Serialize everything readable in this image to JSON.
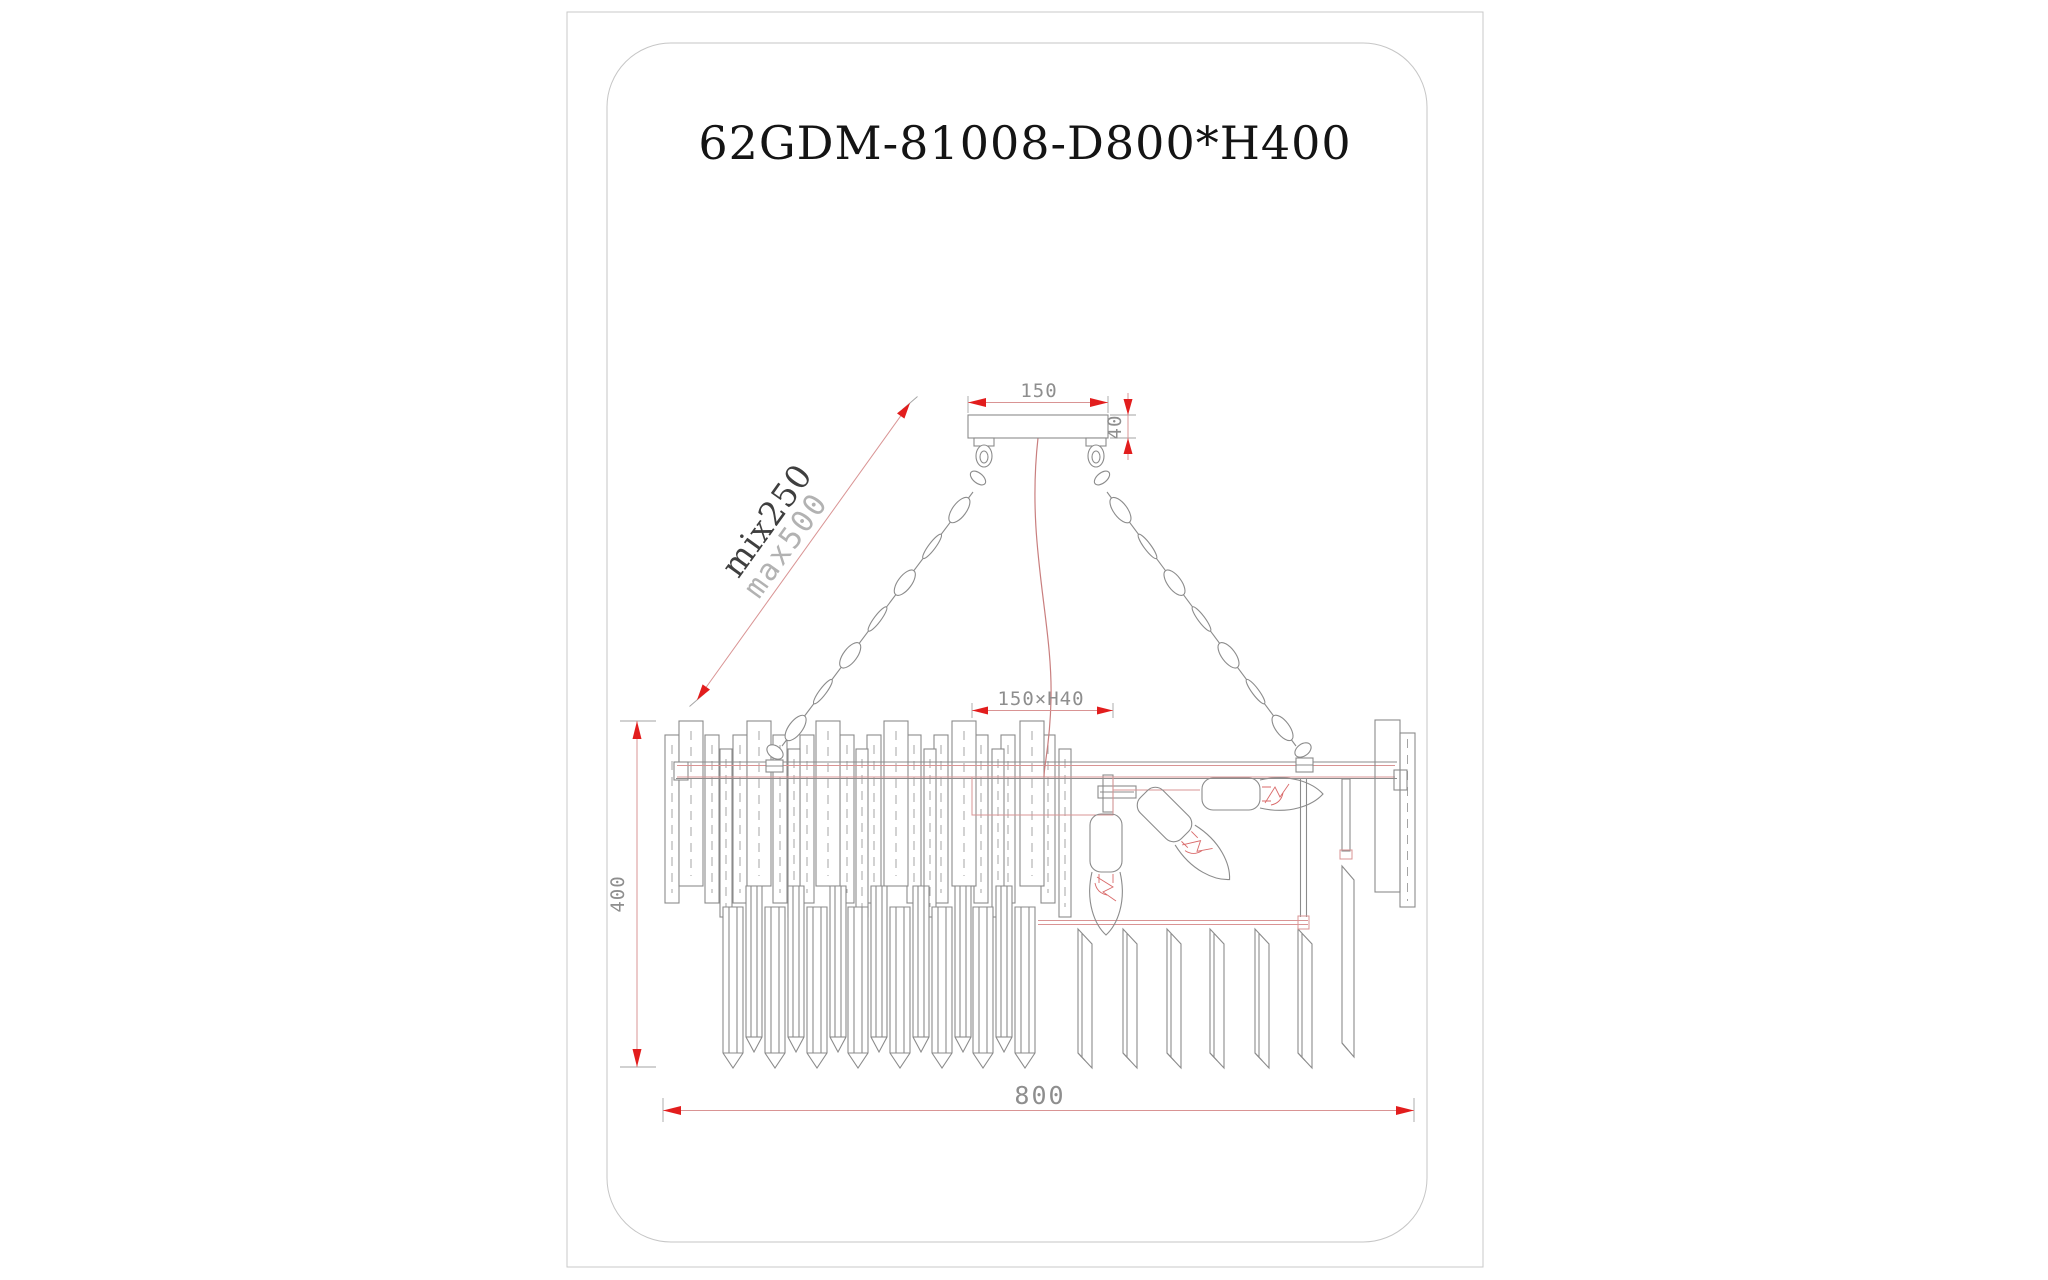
{
  "title": "62GDM-81008-D800*H400",
  "dimensions": {
    "canopy_width": "150",
    "canopy_thickness": "40",
    "chain_min": "mix250",
    "chain_max": "max500",
    "mount_plate": "150×H40",
    "fixture_height": "400",
    "fixture_diameter": "800"
  },
  "colors": {
    "drawing_line": "#8b8b8b",
    "dimension_line": "#d99494",
    "dimension_arrow": "#e21d1d",
    "dimension_text": "#8e8e8e",
    "structure_red": "#d99494",
    "wire_red": "#c97f7f",
    "title_text": "#141414",
    "page_border": "#c9c9c9"
  }
}
